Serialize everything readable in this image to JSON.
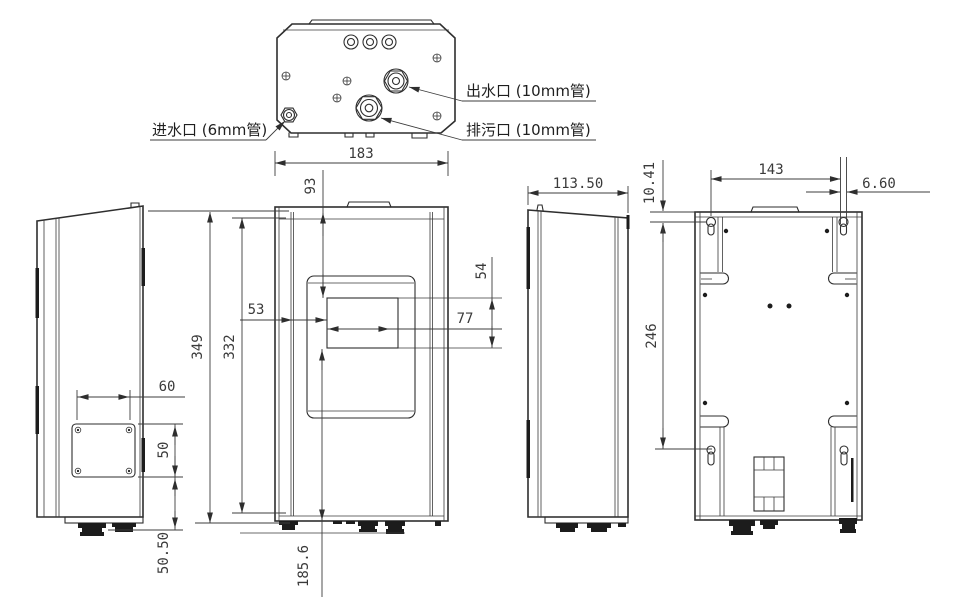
{
  "ports": {
    "inlet": "进水口 (6mm管)",
    "outlet": "出水口 (10mm管)",
    "drain": "排污口 (10mm管)"
  },
  "dims": {
    "front_width": "183",
    "top_to_window": "93",
    "overall_height": "349",
    "body_height": "332",
    "window_left": "53",
    "window_width": "77",
    "window_height": "54",
    "window_to_bottom": "185.6",
    "depth": "113.50",
    "mount_top": "10.41",
    "mount_span_h": "143",
    "slot_width": "6.60",
    "mount_span_v": "246",
    "panel_width": "60",
    "panel_height": "50",
    "panel_bottom": "50.50"
  },
  "colors": {
    "line": "#2e2e2e",
    "background": "#ffffff"
  }
}
